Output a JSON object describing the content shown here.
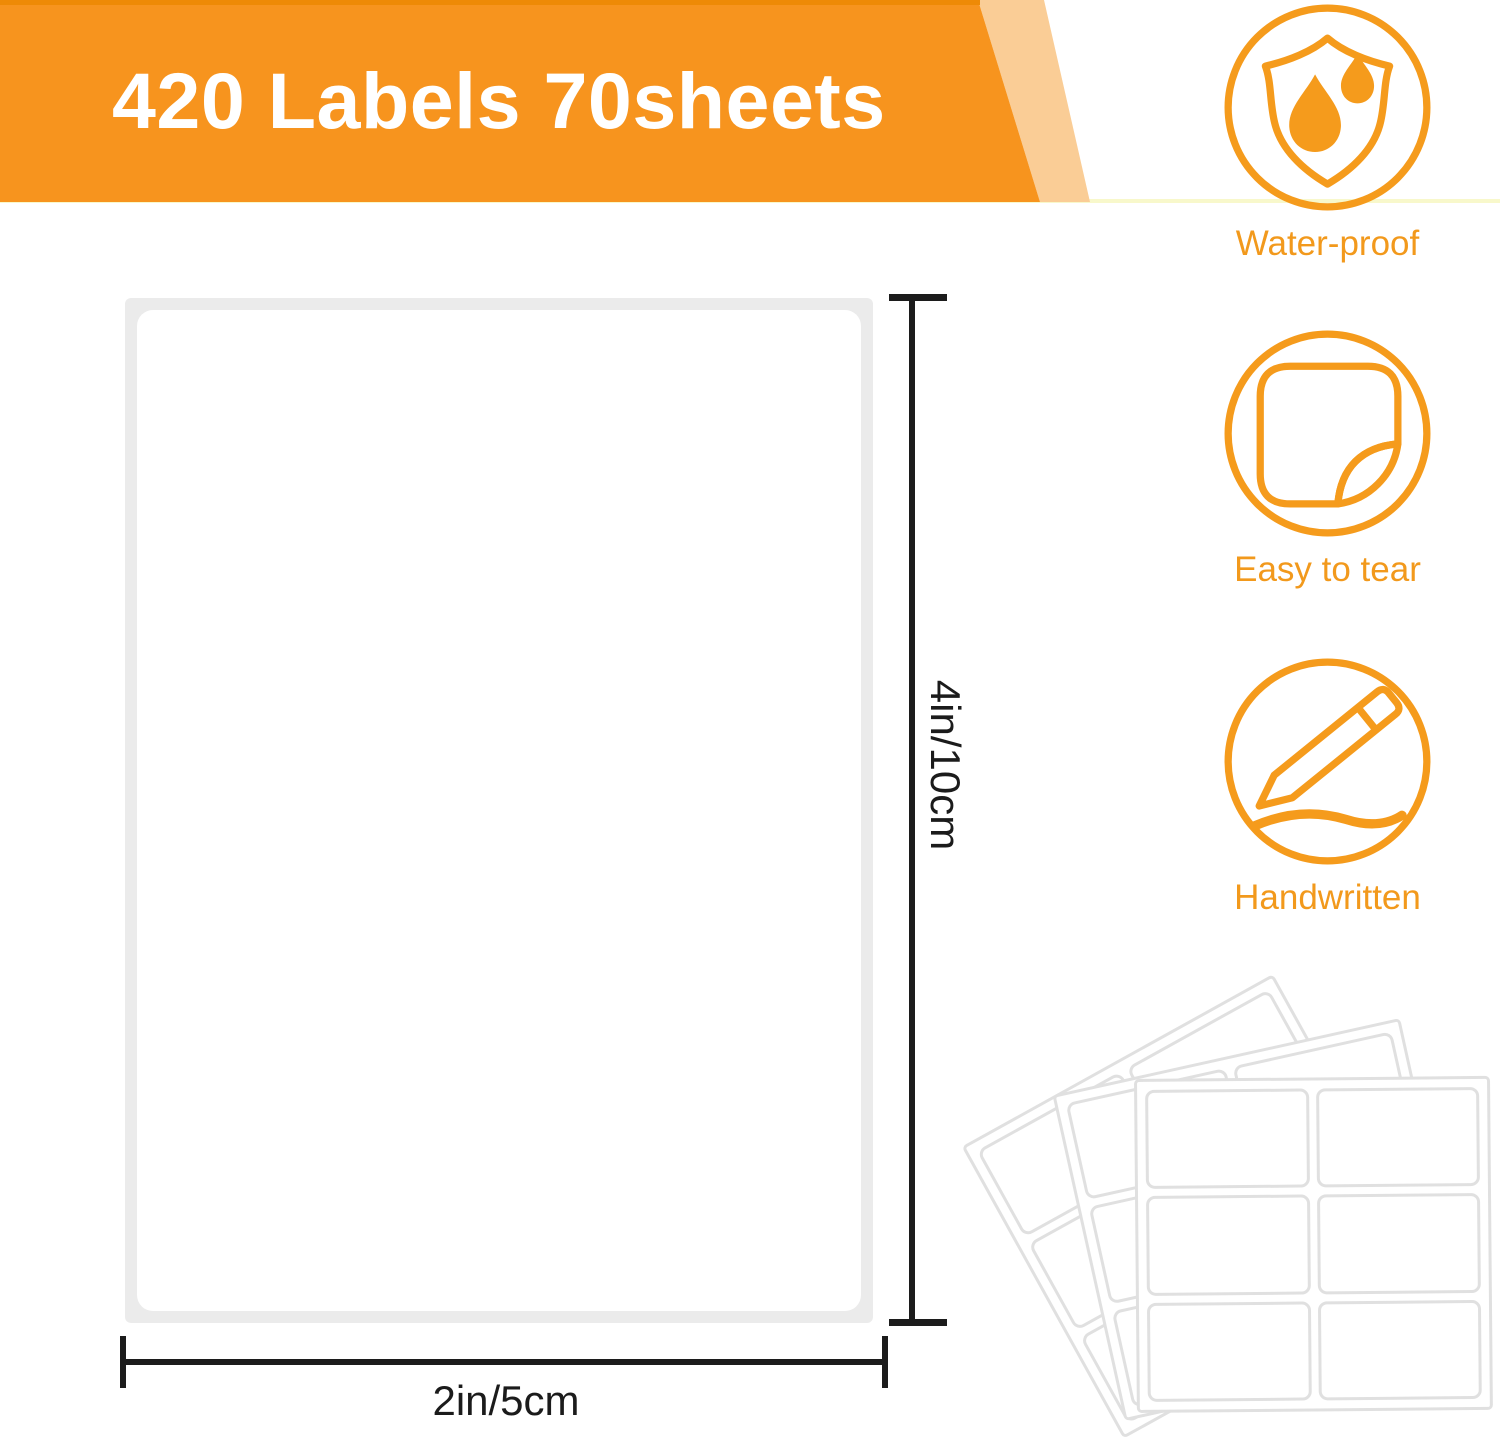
{
  "banner": {
    "title": "420 Labels 70sheets"
  },
  "features": [
    {
      "icon": "waterproof-shield-icon",
      "label": "Water-proof"
    },
    {
      "icon": "easy-tear-sticker-icon",
      "label": "Easy to tear"
    },
    {
      "icon": "handwritten-pencil-icon",
      "label": "Handwritten"
    }
  ],
  "diagram": {
    "height_label": "4in/10cm",
    "width_label": "2in/5cm"
  },
  "colors": {
    "banner_orange": "#f7941e",
    "banner_orange_light": "#facd96",
    "banner_top_strip": "#ee8a06",
    "banner_bottom_line": "#f8f8cb",
    "icon_orange": "#f2991c",
    "dimension_line": "#1c1c1c",
    "sheet_frame_gray": "#ebebeb",
    "label_border_gray": "#e0e0e0"
  }
}
